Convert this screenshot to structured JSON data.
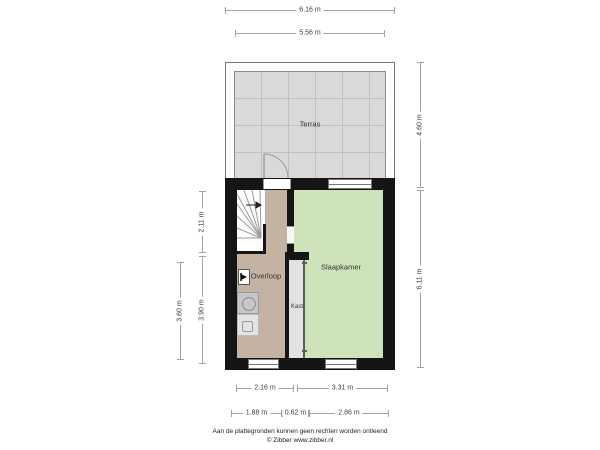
{
  "plan": {
    "rooms": [
      {
        "id": "terras",
        "label": "Terras"
      },
      {
        "id": "overloop",
        "label": "Overloop"
      },
      {
        "id": "slaapkamer",
        "label": "Slaapkamer"
      },
      {
        "id": "kast",
        "label": "Kast"
      }
    ],
    "dimensions": {
      "top_outer": "6.16 m",
      "top_inner": "5.56 m",
      "right_terrace": "4.60 m",
      "right_interior": "6.11 m",
      "left_stairs": "2.11 m",
      "left_lower_inner": "3.90 m",
      "left_lower_outer": "3.60 m",
      "bottom_inner_left": "2.16 m",
      "bottom_inner_right": "3.31 m",
      "bottom_outer_left": "1.88 m",
      "bottom_outer_mid": "0.62 m",
      "bottom_outer_right": "2.86 m"
    },
    "icons": [
      "stairs-icon",
      "stairs-direction-arrow-icon",
      "door-arc-icon",
      "window-icon",
      "washer-icon",
      "appliance-icon",
      "wall-fixture-icon"
    ],
    "colors": {
      "wall": "#151515",
      "terrace_floor": "#d9d9d9",
      "overloop_floor": "#c4b2a2",
      "slaapkamer_floor": "#cde4bb",
      "kast_floor": "#e2e2e2"
    }
  },
  "footer": {
    "disclaimer": "Aan de plattegronden kunnen geen rechten worden ontleend",
    "credit": "© Zibber www.zibber.nl"
  }
}
